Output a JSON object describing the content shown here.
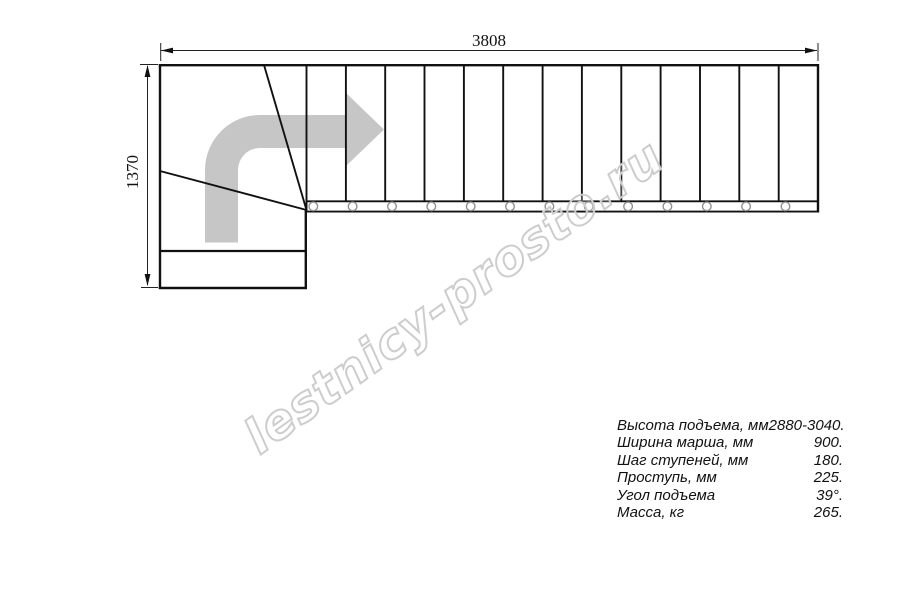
{
  "drawing": {
    "type": "staircase top view plan",
    "dimensions": {
      "total_length_mm": "3808",
      "total_width_mm": "1370"
    },
    "straight_tread_count": 13,
    "winder_tread_count": 3,
    "colors": {
      "line": "#111111",
      "direction_arrow": "#c6c6c6",
      "watermark_outline": "#cdcdcd",
      "background": "#ffffff"
    }
  },
  "watermark": {
    "text": "lestnicy-prosto.ru"
  },
  "specs": {
    "rows": [
      {
        "label": "Высота подъема, мм",
        "value": "2880-3040."
      },
      {
        "label": "Ширина марша, мм",
        "value": "900."
      },
      {
        "label": "Шаг ступеней, мм",
        "value": "180."
      },
      {
        "label": "Проступь, мм",
        "value": "225."
      },
      {
        "label": "Угол подъема",
        "value": "39°."
      },
      {
        "label": "Масса, кг",
        "value": "265."
      }
    ]
  }
}
